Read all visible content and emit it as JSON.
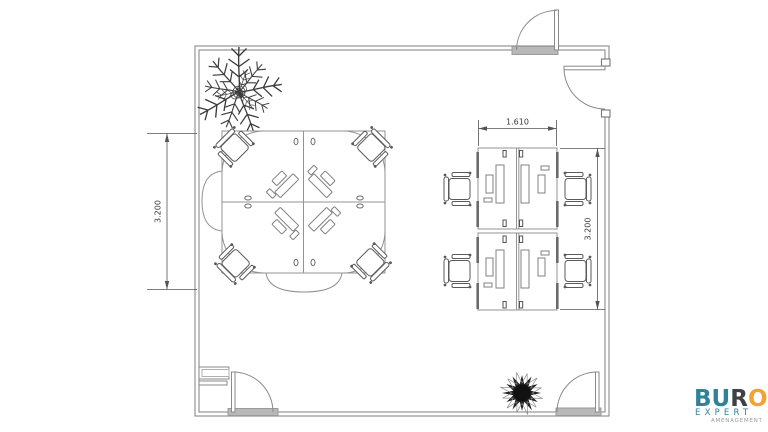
{
  "dimensions": {
    "left": "3.200",
    "top_right": "1.610",
    "right": "3.200"
  },
  "logo": {
    "letters": [
      {
        "ch": "B",
        "color": "#2e8398"
      },
      {
        "ch": "U",
        "color": "#2e8398"
      },
      {
        "ch": "R",
        "color": "#3f4145"
      },
      {
        "ch": "O",
        "color": "#f2a134"
      }
    ],
    "line2": {
      "text": "EXPERT",
      "color": "#2e8398"
    },
    "line3": {
      "text": "AMENAGEMENT",
      "color": "#9aa0a3"
    }
  },
  "colors": {
    "wall": "#8a8a8a",
    "furniture": "#939393",
    "chair": "#5a5a5a",
    "equipment": "#808080",
    "threshold": "#b8b8b8",
    "dimension": "#555555",
    "plant": "#3c3c3c",
    "plant_dark": "#222222"
  }
}
